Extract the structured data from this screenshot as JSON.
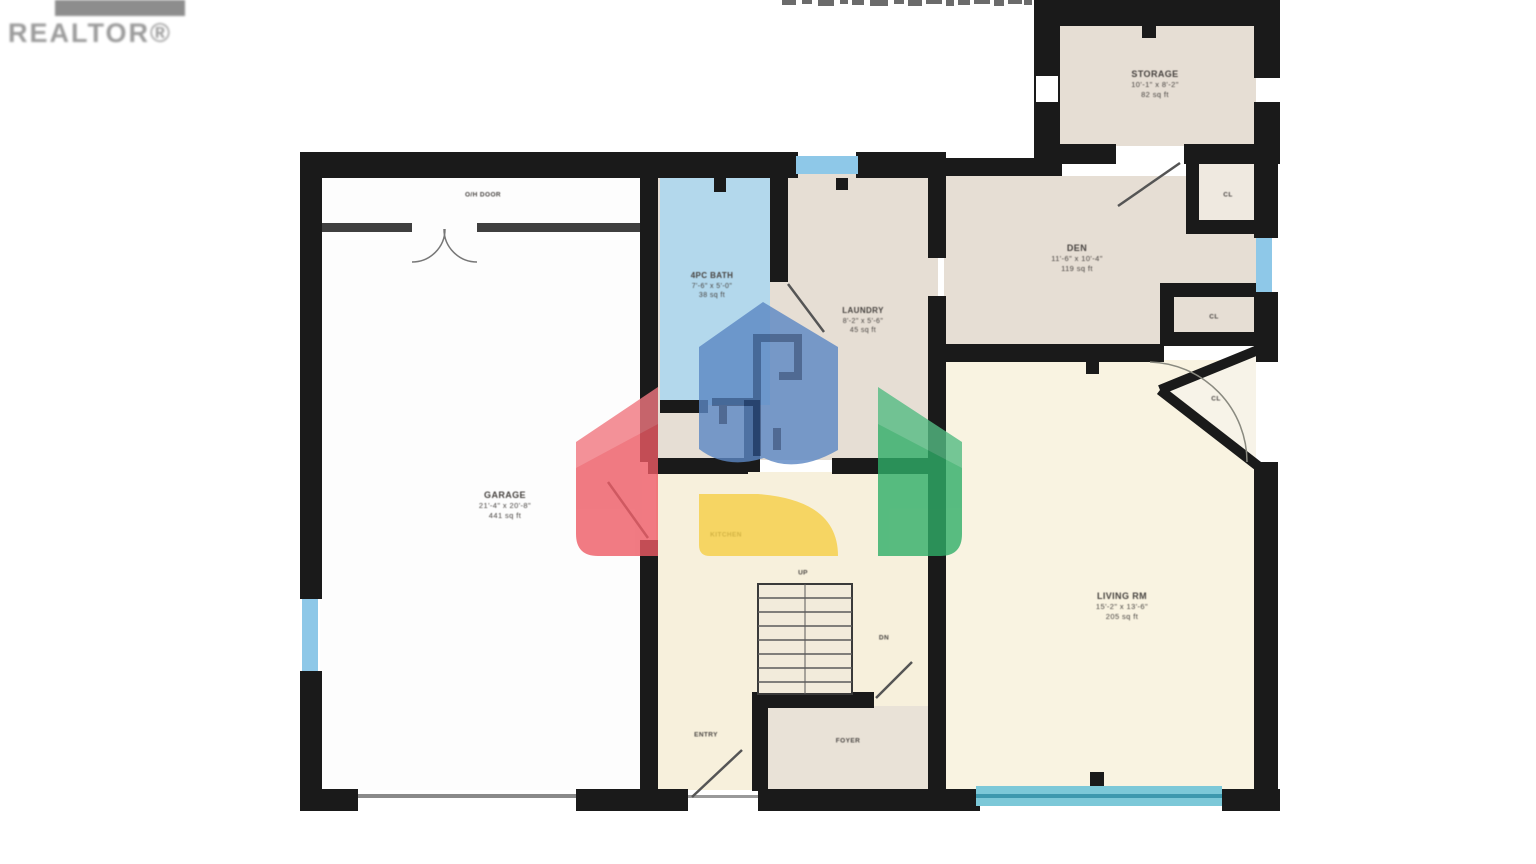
{
  "branding": {
    "realtor_logo_text": "REALTOR®"
  },
  "floorplan": {
    "rooms": {
      "garage": {
        "lines": [
          "GARAGE",
          "21'-4\" x 20'-8\"",
          "441 sq ft"
        ]
      },
      "garage_door": {
        "lines": [
          "O/H DOOR"
        ]
      },
      "bathroom": {
        "lines": [
          "4PC BATH",
          "7'-6\" x 5'-0\"",
          "38 sq ft"
        ]
      },
      "laundry": {
        "lines": [
          "LAUNDRY",
          "8'-2\" x 5'-6\"",
          "45 sq ft"
        ]
      },
      "storage": {
        "lines": [
          "STORAGE",
          "10'-1\" x 8'-2\"",
          "82 sq ft"
        ]
      },
      "den": {
        "lines": [
          "DEN",
          "11'-6\" x 10'-4\"",
          "119 sq ft"
        ]
      },
      "closet_top": {
        "lines": [
          "CL"
        ]
      },
      "closet_mid": {
        "lines": [
          "CL"
        ]
      },
      "closet_corner": {
        "lines": [
          "CL"
        ]
      },
      "living": {
        "lines": [
          "LIVING RM",
          "15'-2\" x 13'-6\"",
          "205 sq ft"
        ]
      },
      "kitchen": {
        "lines": [
          "KITCHEN"
        ]
      },
      "stairs": {
        "lines": [
          "UP"
        ]
      },
      "stair_closet": {
        "lines": [
          "DN"
        ]
      },
      "foyer": {
        "lines": [
          "FOYER"
        ]
      },
      "front_door": {
        "lines": [
          "ENTRY"
        ]
      }
    }
  },
  "palette": {
    "wall": "#1a1a1a",
    "window_blue": "#8ec8e8",
    "window_teal": "#7cc8d8",
    "room_beige": "#e6ded4",
    "room_cream": "#f9f3e1",
    "room_pale_yellow": "#f7f0dc",
    "bath_blue": "#b3d8ec",
    "watermark_red": "#ee5a64",
    "watermark_green": "#2fae68",
    "watermark_blue": "#5b87c4",
    "watermark_navy": "#27497e",
    "watermark_yellow": "#f6cf45",
    "logo_gray": "#8d8d8d"
  }
}
